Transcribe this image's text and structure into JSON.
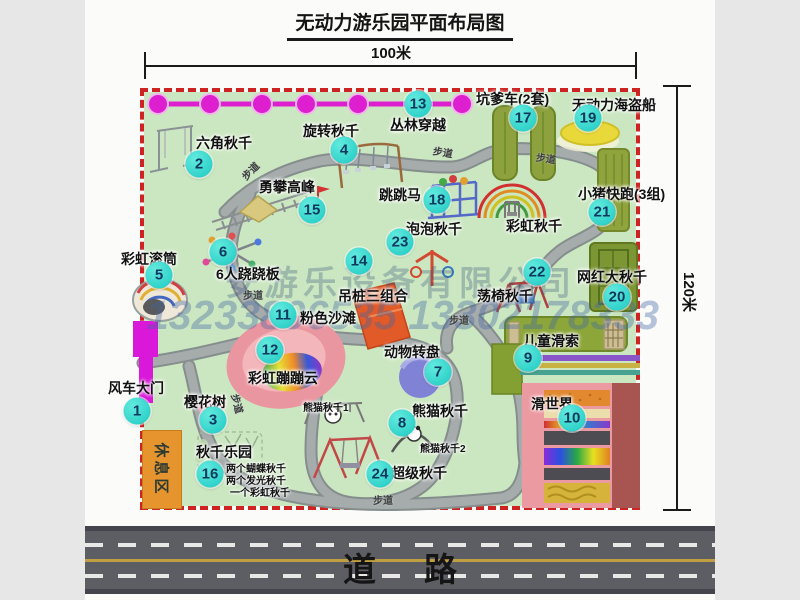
{
  "title": "无动力游乐园平面布局图",
  "dimensions": {
    "top": "100米",
    "right": "120米"
  },
  "road": {
    "label": "道路"
  },
  "watermark": {
    "company": "安游乐设备有限公司",
    "phones": "13233806535 13302178333"
  },
  "rest_area": {
    "label": "休息区"
  },
  "colors": {
    "park_fill": "#cbe7c1",
    "park_border": "#ce2323",
    "marker": "#1cc9c2",
    "chain": "#dd1fd0",
    "road": "#5d5d64",
    "rest_area": "#e6952e"
  },
  "markers": [
    {
      "num": "1",
      "label": "风车大门",
      "lx": 108,
      "ly": 378,
      "cx": 137,
      "cy": 411
    },
    {
      "num": "2",
      "label": "六角秋千",
      "lx": 196,
      "ly": 133,
      "cx": 199,
      "cy": 164
    },
    {
      "num": "3",
      "label": "樱花树",
      "lx": 184,
      "ly": 392,
      "cx": 213,
      "cy": 420
    },
    {
      "num": "4",
      "label": "旋转秋千",
      "lx": 303,
      "ly": 121,
      "cx": 344,
      "cy": 150
    },
    {
      "num": "5",
      "label": "彩虹滚筒",
      "lx": 121,
      "ly": 249,
      "cx": 159,
      "cy": 275
    },
    {
      "num": "6",
      "label": "6人跷跷板",
      "lx": 216,
      "ly": 264,
      "cx": 223,
      "cy": 252
    },
    {
      "num": "7",
      "label": "动物转盘",
      "lx": 384,
      "ly": 342,
      "cx": 438,
      "cy": 372
    },
    {
      "num": "8",
      "label": "熊猫秋千",
      "lx": 412,
      "ly": 401,
      "cx": 402,
      "cy": 423
    },
    {
      "num": "9",
      "label": "儿童滑索",
      "lx": 523,
      "ly": 331,
      "cx": 528,
      "cy": 358
    },
    {
      "num": "10",
      "label": "滑世界",
      "lx": 531,
      "ly": 394,
      "cx": 572,
      "cy": 418
    },
    {
      "num": "11",
      "label": "粉色沙滩",
      "lx": 300,
      "ly": 308,
      "cx": 283,
      "cy": 315
    },
    {
      "num": "12",
      "label": "彩虹蹦蹦云",
      "lx": 248,
      "ly": 368,
      "cx": 270,
      "cy": 350
    },
    {
      "num": "13",
      "label": "丛林穿越",
      "lx": 390,
      "ly": 115,
      "cx": 418,
      "cy": 104
    },
    {
      "num": "14",
      "label": "吊桩三组合",
      "lx": 338,
      "ly": 286,
      "cx": 359,
      "cy": 261
    },
    {
      "num": "15",
      "label": "勇攀高峰",
      "lx": 259,
      "ly": 177,
      "cx": 312,
      "cy": 210
    },
    {
      "num": "16",
      "label": "秋千乐园",
      "lx": 196,
      "ly": 442,
      "cx": 210,
      "cy": 474
    },
    {
      "num": "17",
      "label": "坑爹车(2套)",
      "lx": 476,
      "ly": 89,
      "cx": 523,
      "cy": 118
    },
    {
      "num": "18",
      "label": "跳跳马",
      "lx": 379,
      "ly": 185,
      "cx": 437,
      "cy": 200
    },
    {
      "num": "19",
      "label": "无动力海盗船",
      "lx": 572,
      "ly": 95,
      "cx": 588,
      "cy": 118
    },
    {
      "num": "20",
      "label": "网红大秋千",
      "lx": 577,
      "ly": 267,
      "cx": 617,
      "cy": 297
    },
    {
      "num": "21",
      "label": "小猪快跑(3组)",
      "lx": 578,
      "ly": 184,
      "cx": 602,
      "cy": 212
    },
    {
      "num": "22",
      "label": "荡椅秋千",
      "lx": 477,
      "ly": 286,
      "cx": 537,
      "cy": 272
    },
    {
      "num": "23",
      "label": "泡泡秋千",
      "lx": 406,
      "ly": 219,
      "cx": 400,
      "cy": 242
    },
    {
      "num": "24",
      "label": "超级秋千",
      "lx": 391,
      "ly": 463,
      "cx": 380,
      "cy": 474
    },
    {
      "num": "",
      "label": "彩虹秋千",
      "lx": 506,
      "ly": 216,
      "cx": 0,
      "cy": 0
    }
  ],
  "extra_labels": [
    {
      "text": "熊猫秋千1",
      "x": 303,
      "y": 399
    },
    {
      "text": "熊猫秋千2",
      "x": 420,
      "y": 440
    },
    {
      "text": "两个蝴蝶秋千",
      "x": 226,
      "y": 460
    },
    {
      "text": "两个发光秋千",
      "x": 226,
      "y": 472
    },
    {
      "text": "一个彩虹秋千",
      "x": 230,
      "y": 484
    }
  ],
  "path_labels": [
    {
      "text": "步道",
      "x": 240,
      "y": 163,
      "rot": -45
    },
    {
      "text": "步道",
      "x": 433,
      "y": 144,
      "rot": 10
    },
    {
      "text": "步道",
      "x": 536,
      "y": 150,
      "rot": 8
    },
    {
      "text": "步道",
      "x": 243,
      "y": 287,
      "rot": 0
    },
    {
      "text": "步道",
      "x": 449,
      "y": 312,
      "rot": 0
    },
    {
      "text": "步道",
      "x": 228,
      "y": 396,
      "rot": 75
    },
    {
      "text": "步道",
      "x": 373,
      "y": 492,
      "rot": 0
    }
  ]
}
